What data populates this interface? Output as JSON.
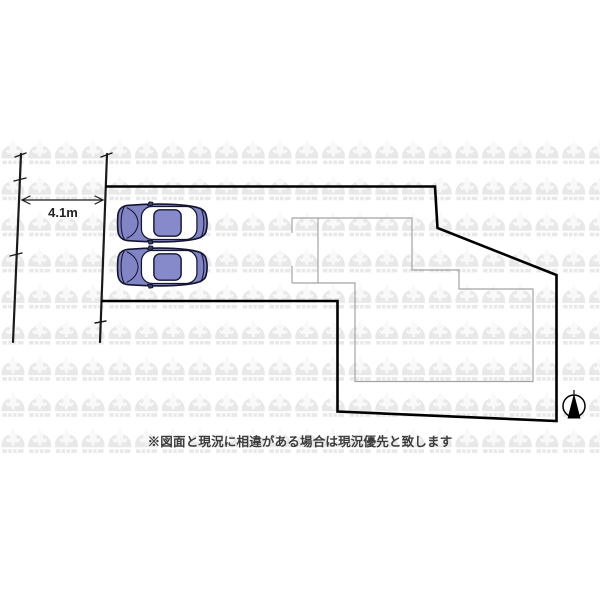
{
  "plan": {
    "dimension_label": "4.1m",
    "disclaimer": "※図面と現況に相違がある場合は現況優先と致します",
    "cars_count": 2,
    "compass": "north-arrow"
  },
  "colors": {
    "boundary": "#000000",
    "road_line": "#1a1a1a",
    "building_outline": "#a3a3a3",
    "car_body": "#8184c5",
    "car_roof": "#8689ca",
    "car_outline": "#14142e",
    "car_glass": "#ffffff",
    "watermark": "#e8e8e8",
    "compass_needle": "#000000"
  }
}
